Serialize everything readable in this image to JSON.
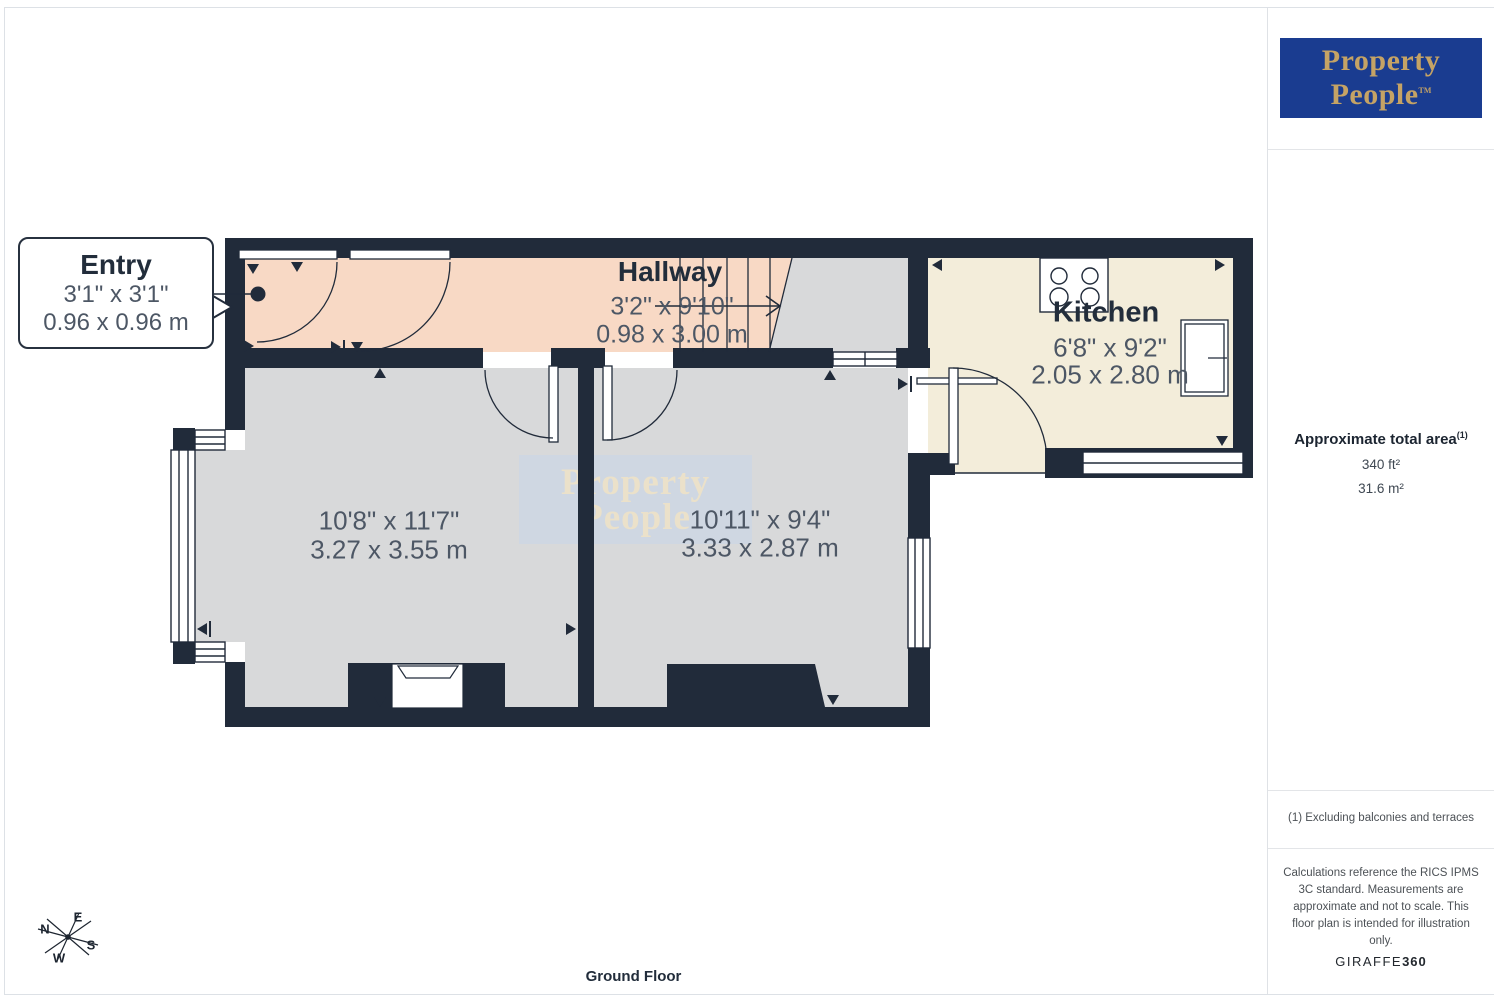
{
  "logo": {
    "line1": "Property",
    "line2": "People",
    "tm": "TM"
  },
  "sidebar": {
    "area_title": "Approximate total area",
    "area_ref": "(1)",
    "area_ft": "340 ft²",
    "area_m": "31.6 m²",
    "note": "(1) Excluding balconies and terraces",
    "disclaimer": "Calculations reference the RICS IPMS 3C standard. Measurements are approximate and not to scale. This floor plan is intended for illustration only.",
    "brand": "GIRAFFE",
    "brand_suffix": "360"
  },
  "plan": {
    "floor_label": "Ground Floor",
    "entry": {
      "name": "Entry",
      "imperial": "3'1\" x 3'1\"",
      "metric": "0.96 x 0.96 m"
    },
    "hallway": {
      "name": "Hallway",
      "imperial": "3'2\" x 9'10\"",
      "metric": "0.98 x 3.00 m"
    },
    "kitchen": {
      "name": "Kitchen",
      "imperial": "6'8\" x 9'2\"",
      "metric": "2.05 x 2.80 m"
    },
    "room1": {
      "imperial": "10'8\" x 11'7\"",
      "metric": "3.27 x 3.55 m"
    },
    "room2": {
      "imperial": "10'11\" x 9'4\"",
      "metric": "3.33 x 2.87 m"
    },
    "watermark": {
      "line1": "Property",
      "line2": "People"
    },
    "compass": {
      "n": "N",
      "e": "E",
      "s": "S",
      "w": "W"
    }
  },
  "colors": {
    "wall": "#212b3a",
    "hallway_floor": "#f8d9c5",
    "kitchen_floor": "#f3edda",
    "room_floor": "#d8d9da",
    "logo_blue": "#1a3c90",
    "logo_gold": "#c5a365",
    "watermark_bg": "#cdd6e3",
    "watermark_text": "#ece2c8"
  }
}
